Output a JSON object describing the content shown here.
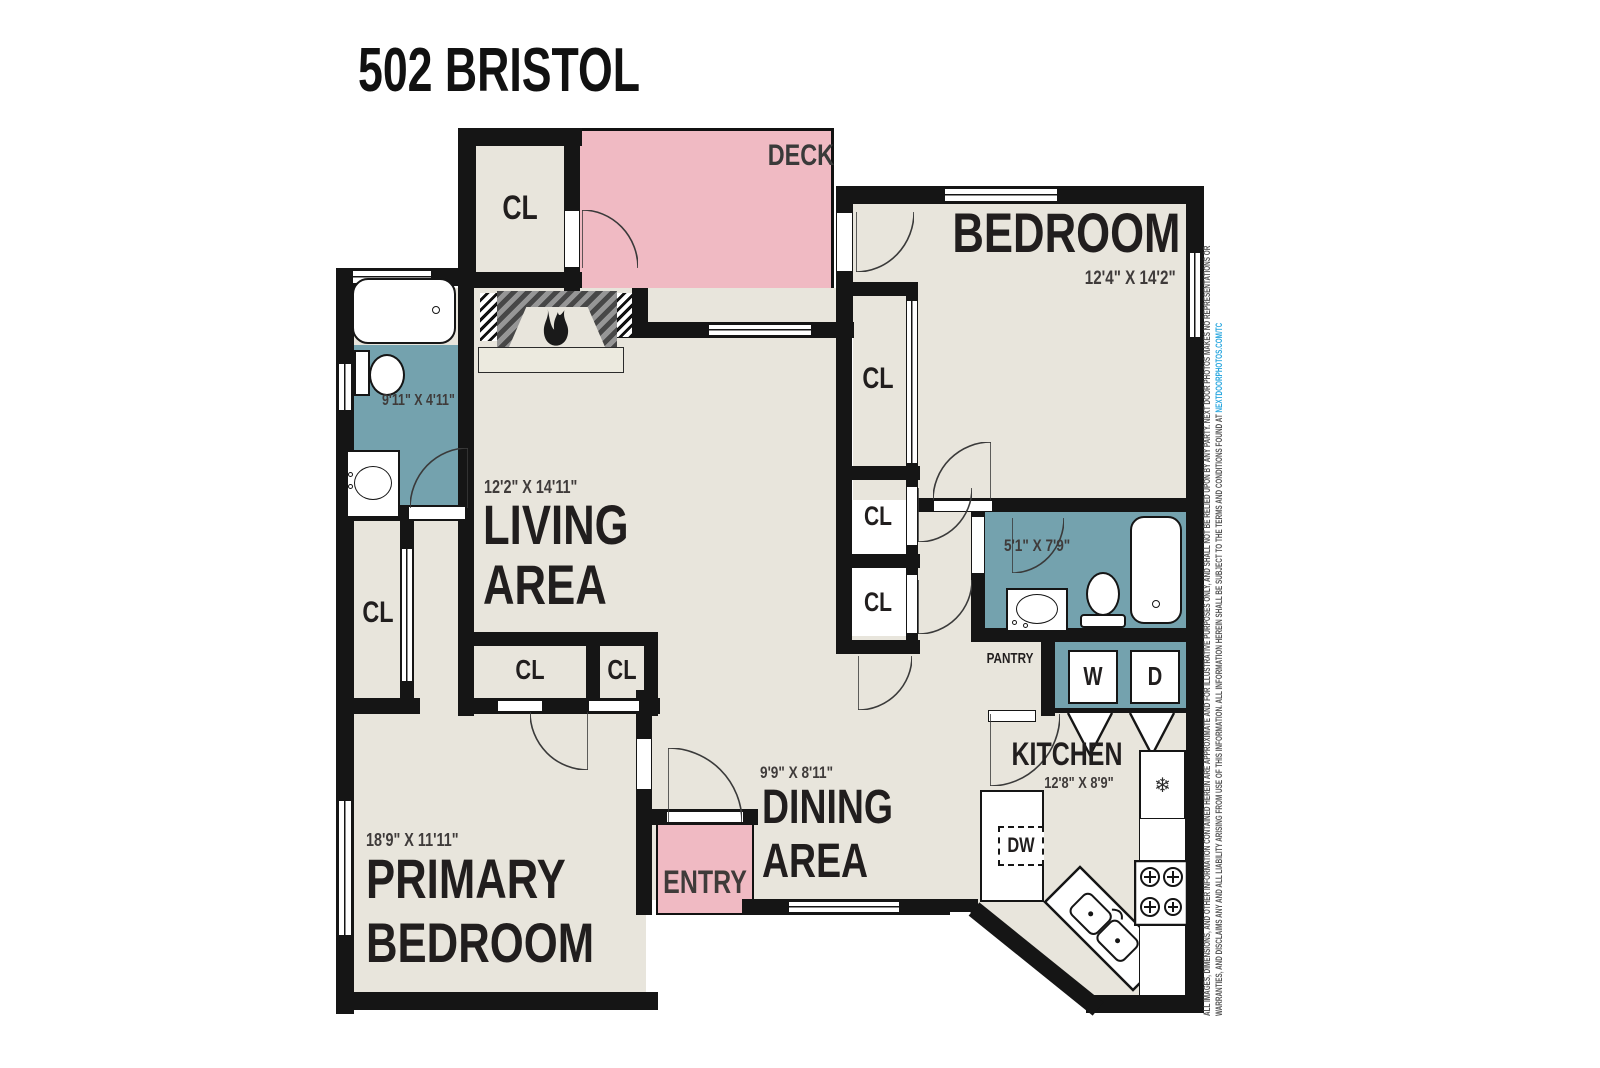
{
  "title": "502 BRISTOL",
  "rooms": {
    "deck": "DECK",
    "bedroom": "BEDROOM",
    "bedroom_dims": "12'4\" X 14'2\"",
    "living_line1": "LIVING",
    "living_line2": "AREA",
    "living_dims": "12'2\" X 14'11\"",
    "dining_line1": "DINING",
    "dining_line2": "AREA",
    "dining_dims": "9'9\" X 8'11\"",
    "kitchen": "KITCHEN",
    "kitchen_dims": "12'8\" X 8'9\"",
    "primary_line1": "PRIMARY",
    "primary_line2": "BEDROOM",
    "primary_dims": "18'9\" X 11'11\"",
    "entry": "ENTRY",
    "pantry": "PANTRY",
    "bath_main_dims": "9'11\" X 4'11\"",
    "bath_second_dims": "5'1\" X 7'9\"",
    "closet": "CL"
  },
  "appliances": {
    "washer": "W",
    "dryer": "D",
    "dishwasher": "DW",
    "fridge_icon": "❄"
  },
  "disclaimer": {
    "line1": "ALL IMAGES, DIMENSIONS, AND OTHER INFORMATION CONTAINED HEREIN ARE APPROXIMATE AND FOR ILLUSTRATIVE PURPOSES ONLY, AND SHALL NOT BE RELIED UPON BY ANY PARTY. NEXT DOOR PHOTOS MAKES NO REPRESENTATIONS OR",
    "line2": "WARRANTIES, AND DISCLAIMS ANY AND ALL LIABILITY ARISING FROM USE OF THIS INFORMATION. ALL INFORMATION HEREIN SHALL BE SUBJECT TO THE TERMS AND CONDITIONS FOUND AT ",
    "link": "NEXTDOORPHOTOS.COM/TC"
  },
  "colors": {
    "wall": "#151515",
    "floor": "#e8e5dc",
    "accent_pink": "#f0bac3",
    "accent_teal": "#74a2ae",
    "link_blue": "#2aa7df"
  }
}
